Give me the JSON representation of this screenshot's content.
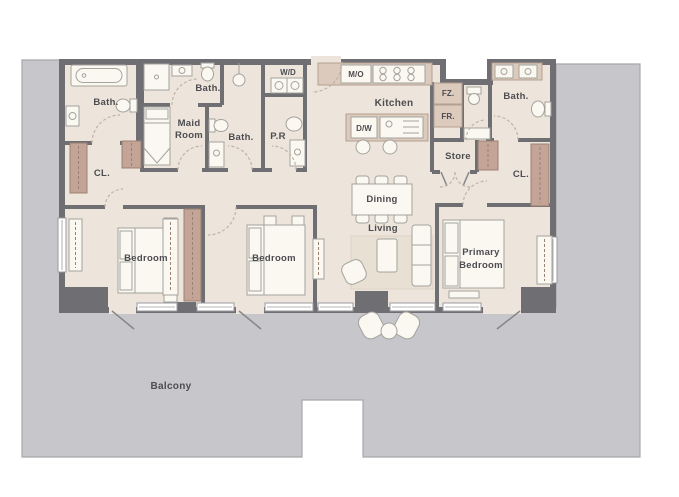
{
  "plan": {
    "type": "apartment-floor-plan",
    "description_visible_rooms": [
      "Bath.",
      "Maid Room",
      "Bath.",
      "P.R",
      "W/D",
      "M/O",
      "Kitchen",
      "D/W",
      "FZ.",
      "FR.",
      "Bath.",
      "Store",
      "CL.",
      "CL.",
      "Dining",
      "Living",
      "Bedroom",
      "Bedroom",
      "Primary Bedroom",
      "Balcony"
    ]
  },
  "colors": {
    "background": "#ffffff",
    "outdoor_gray": "#c7c6ca",
    "wall_dark": "#6f6e73",
    "floor_cream": "#ede5db",
    "closet_brown": "#c3a496",
    "counter_tan": "#dccabc",
    "label_text": "#4c4c51"
  },
  "rooms": {
    "bath_top_left": {
      "label": "Bath."
    },
    "closet_left": {
      "label": "CL."
    },
    "maid_bath": {
      "label": "Bath."
    },
    "maid_room": {
      "line1": "Maid",
      "line2": "Room"
    },
    "bath_middle": {
      "label": "Bath."
    },
    "powder_room": {
      "label": "P.R"
    },
    "washer_dryer": {
      "label": "W/D"
    },
    "microwave_oven": {
      "label": "M/O"
    },
    "kitchen": {
      "label": "Kitchen"
    },
    "dishwasher": {
      "label": "D/W"
    },
    "freezer": {
      "label": "FZ."
    },
    "fridge": {
      "label": "FR."
    },
    "bath_primary": {
      "label": "Bath."
    },
    "store": {
      "label": "Store"
    },
    "closet_right": {
      "label": "CL."
    },
    "dining": {
      "label": "Dining"
    },
    "living": {
      "label": "Living"
    },
    "bedroom_left": {
      "label": "Bedroom"
    },
    "bedroom_middle": {
      "label": "Bedroom"
    },
    "primary_bedroom": {
      "line1": "Primary",
      "line2": "Bedroom"
    },
    "balcony": {
      "label": "Balcony"
    }
  }
}
